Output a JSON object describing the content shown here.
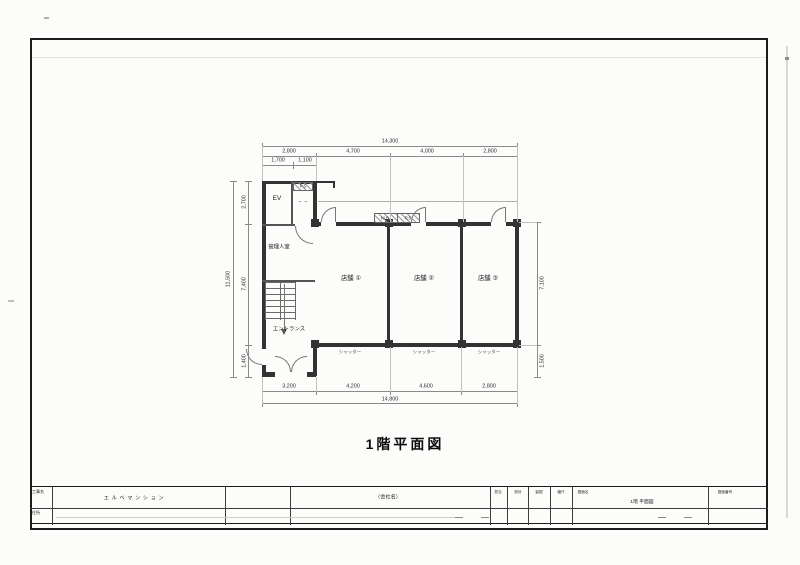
{
  "document": {
    "drawing_title": "1階平面図"
  },
  "plan": {
    "rooms": {
      "elevator": "EV",
      "pipe_space": "P.S",
      "manager_room": "管理人室",
      "entrance": "エントランス",
      "store_1": "店舗 ①",
      "store_2": "店舗 ②",
      "store_3": "店舗 ③",
      "meter_box": "M.B",
      "pipe_space_wall": "P.S",
      "shutter": "シャッター"
    },
    "icons": {
      "hall_direction_arrow": "←→"
    }
  },
  "dimensions": {
    "top_total": "14,300",
    "top_segments": [
      "2,800",
      "4,700",
      "4,000",
      "2,800"
    ],
    "top_sub_segments": [
      "1,700",
      "1,100"
    ],
    "bottom_segments": [
      "3,200",
      "4,200",
      "4,600",
      "2,800"
    ],
    "bottom_total": "14,800",
    "left_total": "11,500",
    "left_segments": [
      "2,700",
      "7,400",
      "1,400"
    ],
    "right_segments": [
      "7,100",
      "1,500"
    ]
  },
  "title_block": {
    "project_label": "工事名",
    "project_name": "エルベマンション",
    "address_label": "住所",
    "company_name": "（会社名）",
    "staff_labels": [
      "担当",
      "設計",
      "製図",
      "縮尺"
    ],
    "drawing_name_label": "図面名",
    "drawing_name": "1階 平面図",
    "drawing_number_label": "図面番号"
  }
}
